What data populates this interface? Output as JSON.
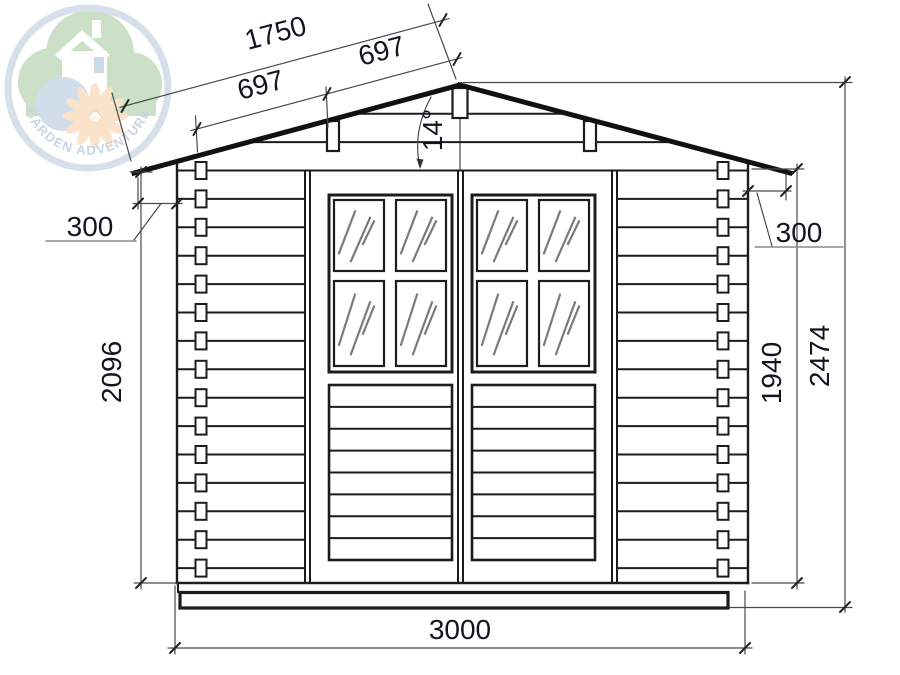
{
  "logo": {
    "brand_text": "GARDEN ADVENTURE"
  },
  "annotations": {
    "roof_slope_total": "1750",
    "roof_slope_seg_left": "697",
    "roof_slope_seg_right": "697",
    "roof_angle": "14°",
    "left_overhang": "300",
    "right_overhang": "300",
    "left_wall_height": "2096",
    "right_wall_height": "1940",
    "total_height": "2474",
    "total_width": "3000"
  },
  "colors": {
    "line": "#1c1c1c",
    "dim_line": "#4a4a4a",
    "glass_hatch": "#7a7a7a",
    "logo_green": "#a3c59a",
    "logo_blue": "#aec3de",
    "logo_ring": "#b6c5da",
    "logo_flower": "#f6cda0"
  }
}
